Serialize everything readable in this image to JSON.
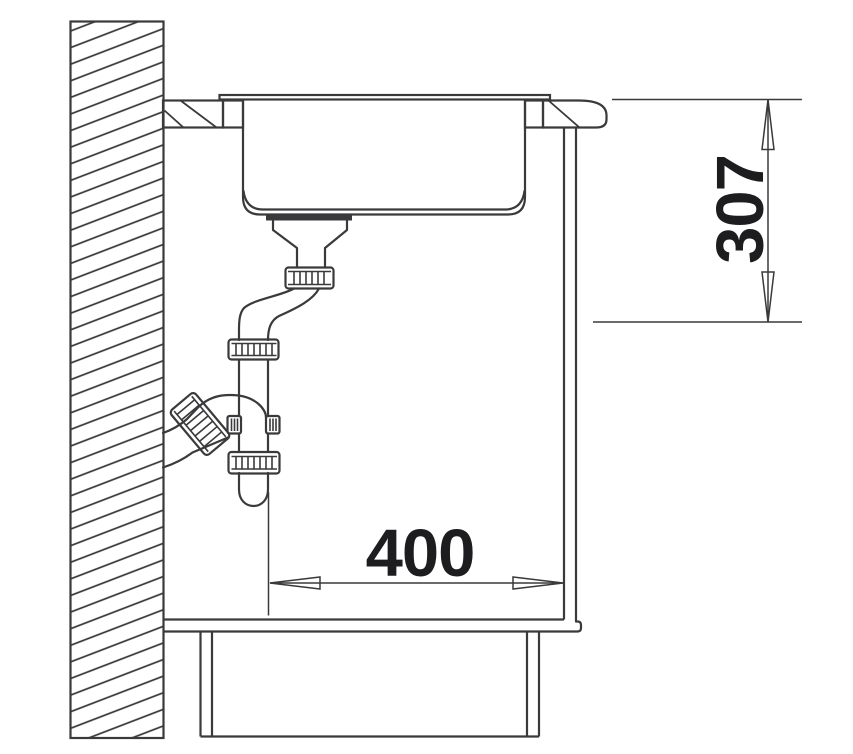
{
  "drawing": {
    "title": "sink-cabinet-side-section",
    "dimensions": {
      "depth_label": "307",
      "width_label": "400"
    },
    "colors": {
      "line": "#3a3a3c",
      "text": "#1d1d1f",
      "background": "#ffffff"
    }
  }
}
